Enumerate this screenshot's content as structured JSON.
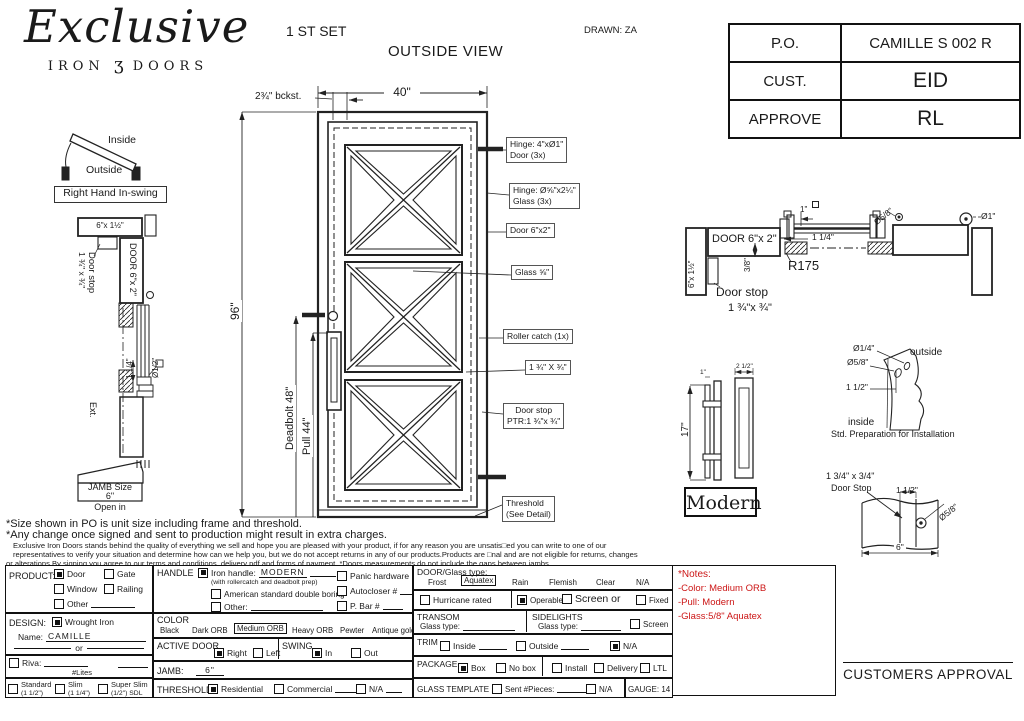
{
  "colors": {
    "ink": "#1a1a1a",
    "red": "#cc1616",
    "paper": "#ffffff"
  },
  "header": {
    "logo_script": "Exclusive",
    "logo_iron": "IRON",
    "logo_ornament": "ʒ",
    "logo_doors": "DOORS",
    "set_label": "1 ST SET",
    "view_label": "OUTSIDE VIEW",
    "drawn_label": "DRAWN: ZA"
  },
  "approval_table": {
    "rows": [
      {
        "label": "P.O.",
        "value": "CAMILLE S 002 R"
      },
      {
        "label": "CUST.",
        "value": "EID"
      },
      {
        "label": "APPROVE",
        "value": "RL"
      }
    ]
  },
  "swing_diagram": {
    "inside": "Inside",
    "outside": "Outside",
    "label": "Right Hand In-swing"
  },
  "left_section": {
    "header_size": "6\"x 1½\"",
    "door_label": "DOOR 6\"x 2\"",
    "door_stop_line1": "Door stop",
    "door_stop_line2": "1 ¾\" x ¾\"",
    "ext_label": "Ext.",
    "dim_1_14": "1 1/4\"",
    "dia_half": "Ø1/2\"",
    "jamb_size_label": "JAMB Size",
    "jamb_size_value": "6\"",
    "open_in": "Open in"
  },
  "door_view": {
    "width_dim": "40\"",
    "backset_dim": "2¾\" bckst.",
    "height_dim": "96\"",
    "deadbolt_dim": "Deadbolt 48\"",
    "pull_dim": "Pull 44\"",
    "callouts": [
      {
        "line1": "Hinge: 4\"xØ1\"",
        "line2": "Door (3x)"
      },
      {
        "line1": "Hinge: Ø⅝\"x2¼\"",
        "line2": "Glass (3x)"
      },
      {
        "line1": "Door 6\"x2\"",
        "line2": ""
      },
      {
        "line1": "Glass ⅝\"",
        "line2": ""
      },
      {
        "line1": "Roller catch  (1x)",
        "line2": ""
      },
      {
        "line1": "1 ¾\" X ¾\"",
        "line2": ""
      },
      {
        "line1": "Door stop",
        "line2": "PTR:1 ¾\"x ¾\""
      },
      {
        "line1": "Threshold",
        "line2": "(See Detail)"
      }
    ]
  },
  "head_section": {
    "door_label": "DOOR 6\"x 2\"",
    "jamb_label": "6\"x 1½\"",
    "dim_1": "1\"",
    "dim_1_14": "1 1/4\"",
    "dim_38": "3/8\"",
    "radius_label": "R175",
    "door_stop_line1": "Door stop",
    "door_stop_line2": "1 ¾\"x ¾\"",
    "dia_58": "Ø5/8\"",
    "dia_1": "Ø1\""
  },
  "pull_detail": {
    "height_dim": "17\"",
    "dim_top": "1\"",
    "dim_width": "2 1/2\"",
    "style_label": "Modern"
  },
  "install_detail": {
    "dia_quarter": "Ø1/4\"",
    "dia_58": "Ø5/8\"",
    "dim_1_12": "1 1/2\"",
    "outside": "outside",
    "inside": "inside",
    "caption": "Std. Preparation for Installation"
  },
  "stop_detail": {
    "label_line1": "1 3/4\" x 3/4\"",
    "label_line2": "Door Stop",
    "dim_1_12": "1 1/2\"",
    "dia_58": "Ø5/8\"",
    "dim_6": "6\"",
    "approval_label": "CUSTOMERS APPROVAL"
  },
  "disclaimer": {
    "line1": "*Size shown in PO is unit size including frame and threshold.",
    "line2": "*Any change once signed and sent to production might result in extra charges.",
    "line3": "Exclusive Iron Doors stands behind the quality of everything we sell and hope you are pleased with your product, if for any reason you are unsatis□ed you can write to one of our",
    "line4": "representatives to verify your situation and determine how can we help you, but we do not accept returns in any of our products.Products are □nal and are not eligible for returns, changes",
    "line5": "or alterations.By signing you agree to our terms and conditions, delivery pdf and forms of payment. *Doors measurements do not include the gaps between jambs"
  },
  "form": {
    "product": {
      "label": "PRODUCT:",
      "opt_door": "Door",
      "opt_gate": "Gate",
      "opt_window": "Window",
      "opt_railing": "Railing",
      "opt_other": "Other",
      "selected": "Door"
    },
    "design": {
      "label": "DESIGN:",
      "opt_wrought": "Wrought Iron",
      "name_label": "Name:",
      "name_value": "CAMILLE",
      "or_label": "or",
      "selected": "Wrought Iron"
    },
    "riva": {
      "label": "Riva:",
      "lites_label": "#Lites"
    },
    "profiles": {
      "opt1": "Standard",
      "opt1_size": "(1 1/2\")",
      "opt2": "Slim",
      "opt2_size": "(1 1/4\")",
      "opt3": "Super Slim",
      "opt3_size": "(1/2\") SDL"
    },
    "handle": {
      "label": "HANDLE",
      "iron_label": "Iron handle:",
      "iron_value": "MODERN",
      "iron_note": "(with rollercatch and deadbolt prep)",
      "opt_american": "American standard double boring",
      "opt_other": "Other:",
      "opt_panic": "Panic hardware",
      "opt_autocloser": "Autocloser #",
      "opt_pbar": "P. Bar #",
      "selected": "Iron handle: MODERN"
    },
    "color": {
      "label": "COLOR",
      "opts": [
        "Black",
        "Dark ORB",
        "Medium ORB",
        "Heavy ORB",
        "Pewter",
        "Antique gold"
      ],
      "selected": "Medium ORB"
    },
    "active_door": {
      "label": "ACTIVE DOOR",
      "opt_right": "Right",
      "opt_left": "Left",
      "selected": "Right"
    },
    "swing": {
      "label": "SWING",
      "opt_in": "In",
      "opt_out": "Out",
      "selected": "In"
    },
    "jamb": {
      "label": "JAMB:",
      "value": "6\""
    },
    "threshold": {
      "label": "THRESHOLD",
      "opt_res": "Residential",
      "opt_com": "Commercial",
      "opt_na": "N/A",
      "selected": "Residential"
    },
    "door_glass": {
      "label": "DOOR/Glass type:",
      "opts": [
        "Frost",
        "Aquatex",
        "Rain",
        "Flemish",
        "Clear",
        "N/A"
      ],
      "selected": "Aquatex"
    },
    "glazing": {
      "opt_hurricane": "Hurricane rated",
      "opt_operable": "Operable",
      "opt_screen": "Screen or",
      "opt_fixed": "Fixed",
      "selected": "Operable"
    },
    "transom": {
      "label": "TRANSOM",
      "glass_label": "Glass type:"
    },
    "sidelights": {
      "label": "SIDELIGHTS",
      "glass_label": "Glass type:",
      "opt_screen": "Screen"
    },
    "trim": {
      "label": "TRIM",
      "opt_inside": "Inside",
      "opt_outside": "Outside",
      "opt_na": "N/A",
      "selected": "N/A"
    },
    "package": {
      "label": "PACKAGE",
      "opt_box": "Box",
      "opt_nobox": "No box",
      "opt_install": "Install",
      "opt_delivery": "Delivery",
      "opt_ltl": "LTL",
      "selected": "Box"
    },
    "glass_template": {
      "label": "GLASS TEMPLATE",
      "opt_sent": "Sent #Pieces:",
      "opt_na": "N/A"
    },
    "gauge_label": "GAUGE: 14",
    "notes": {
      "title": "*Notes:",
      "line1": "-Color: Medium ORB",
      "line2": "-Pull: Modern",
      "line3": "-Glass:5/8\"  Aquatex"
    }
  }
}
